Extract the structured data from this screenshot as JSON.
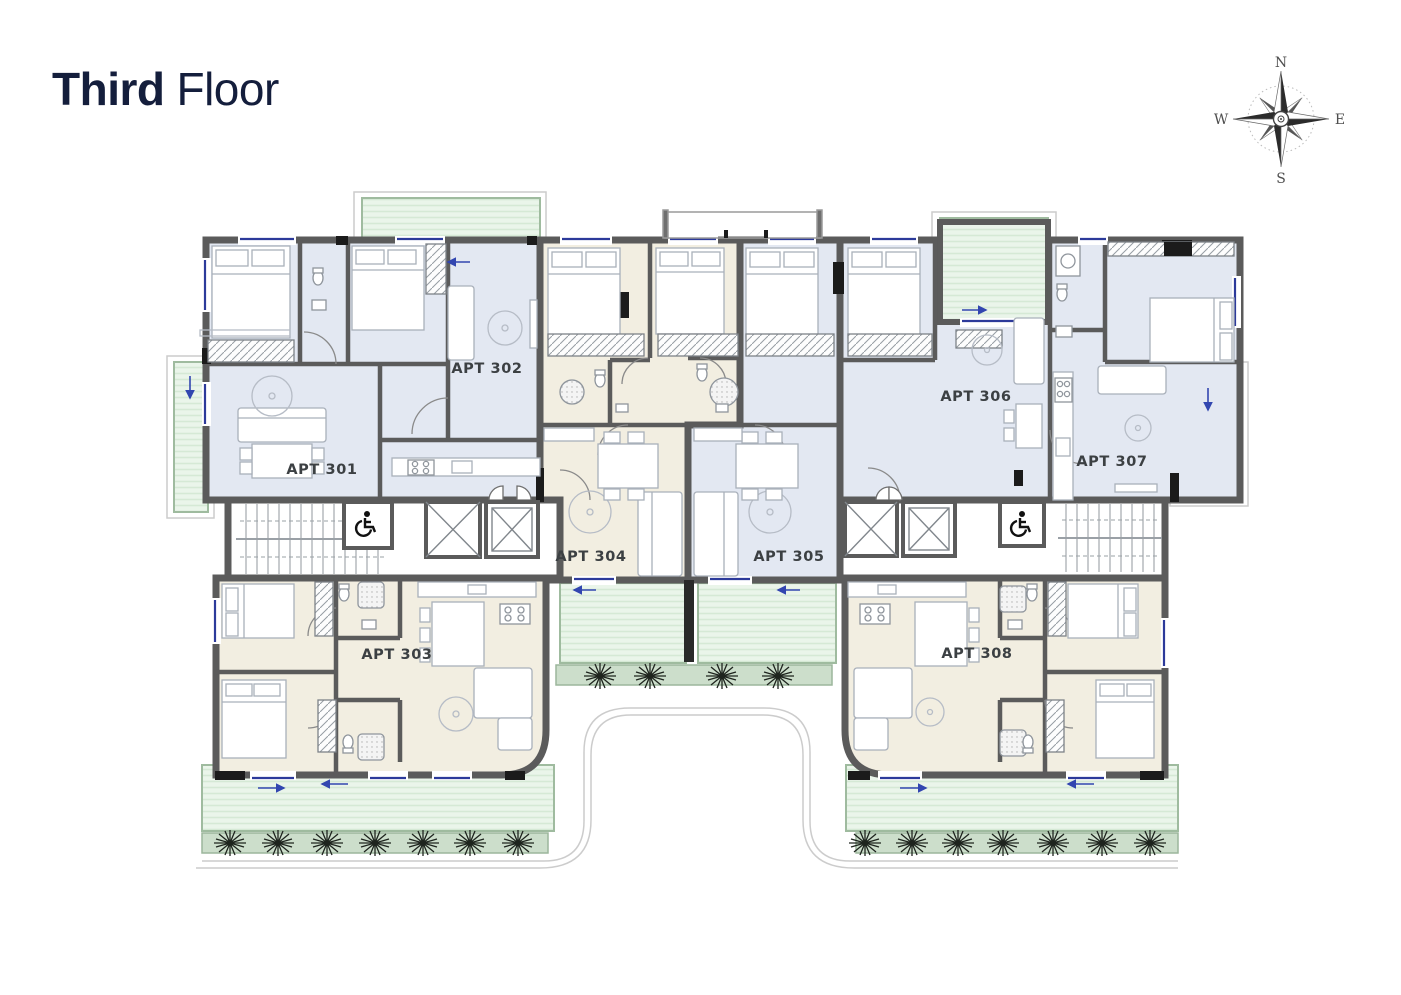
{
  "title": {
    "bold": "Third",
    "light": "Floor"
  },
  "compass": {
    "north": "N",
    "east": "E",
    "south": "S",
    "west": "W"
  },
  "floor_plan": {
    "floor_name": "Third Floor",
    "apartments": [
      {
        "id": "301",
        "label": "APT 301",
        "zone": "blue"
      },
      {
        "id": "302",
        "label": "APT 302",
        "zone": "blue"
      },
      {
        "id": "303",
        "label": "APT 303",
        "zone": "cream"
      },
      {
        "id": "304",
        "label": "APT 304",
        "zone": "cream"
      },
      {
        "id": "305",
        "label": "APT 305",
        "zone": "blue"
      },
      {
        "id": "306",
        "label": "APT 306",
        "zone": "blue"
      },
      {
        "id": "307",
        "label": "APT 307",
        "zone": "blue"
      },
      {
        "id": "308",
        "label": "APT 308",
        "zone": "cream"
      }
    ],
    "colors": {
      "room_blue": "#e3e8f2",
      "room_cream": "#f2eee1",
      "balcony_green": "#eaf5ea",
      "planter_green": "#ccdecb",
      "wall_gray": "#5b5b5b",
      "window_blue": "#2c3a9a",
      "title_navy": "#141e3c"
    },
    "features": [
      "wheelchair-accessible-wc",
      "elevators",
      "stairs",
      "balconies",
      "planters"
    ]
  }
}
